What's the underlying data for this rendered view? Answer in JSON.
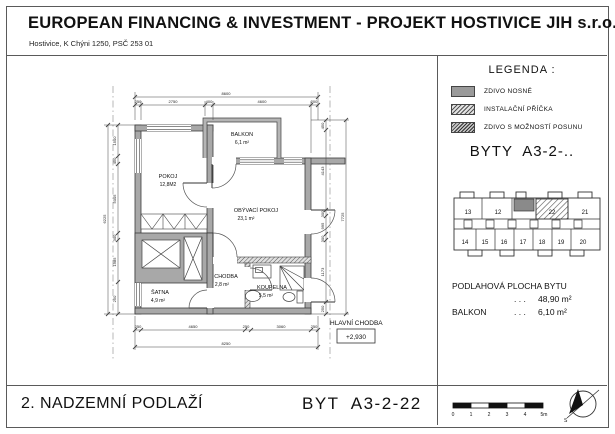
{
  "header": {
    "title": "EUROPEAN FINANCING & INVESTMENT - PROJEKT HOSTIVICE JIH s.r.o.",
    "subtitle": "Hostivice, K Chýni 1250, PSČ 253 01"
  },
  "legend": {
    "heading": "LEGENDA :",
    "items": [
      {
        "label": "ZDIVO NOSNÉ"
      },
      {
        "label": "INSTALAČNÍ PŘÍČKA"
      },
      {
        "label": "ZDIVO S MOŽNOSTÍ POSUNU"
      }
    ]
  },
  "flats_heading": "BYTY  A3-2-..",
  "keyplan": {
    "top_units": [
      "13",
      "12",
      "22",
      "21"
    ],
    "bottom_units": [
      "14",
      "15",
      "16",
      "17",
      "18",
      "19",
      "20"
    ],
    "highlighted_unit": "22"
  },
  "areas": {
    "floor_label": "PODLAHOVÁ PLOCHA BYTU",
    "dots": ". . .",
    "floor_value": "48,90 m²",
    "balcony_label": "BALKON",
    "balcony_value": "6,10 m²"
  },
  "plan": {
    "rooms": [
      {
        "name": "POKOJ",
        "area": "12,8M2"
      },
      {
        "name": "BALKON",
        "area": "6,1 m²"
      },
      {
        "name": "OBÝVACÍ POKOJ",
        "area": "23,1 m²"
      },
      {
        "name": "CHODBA",
        "area": "2,8 m²"
      },
      {
        "name": "ŠATNA",
        "area": "4,9 m²"
      },
      {
        "name": "KOUPELNA",
        "area": "5,5 m²"
      }
    ],
    "corridor_label": "HLAVNÍ CHODBA",
    "level_mark": "+2,930",
    "dims": {
      "top_total": "8600",
      "top_segments": [
        "250",
        "2750",
        "400",
        "4600",
        "200"
      ],
      "bottom_total": "8250",
      "bottom_segments": [
        "250",
        "4650",
        "250",
        "3060",
        "250"
      ],
      "left_total": "6225",
      "left_segments": [
        "1500",
        "450",
        "5005",
        "300",
        "1985",
        "250"
      ],
      "right_total": "7725",
      "right_segments": [
        "450",
        "4143",
        "300",
        "995",
        "300",
        "1173",
        "250"
      ]
    }
  },
  "footer": {
    "floor_label": "2. NADZEMNÍ PODLAŽÍ",
    "unit_label": "BYT  A3-2-22"
  },
  "scalebar": {
    "ticks": [
      "0",
      "1",
      "2",
      "3",
      "4",
      "5m"
    ]
  },
  "compass": {
    "label": "S"
  }
}
